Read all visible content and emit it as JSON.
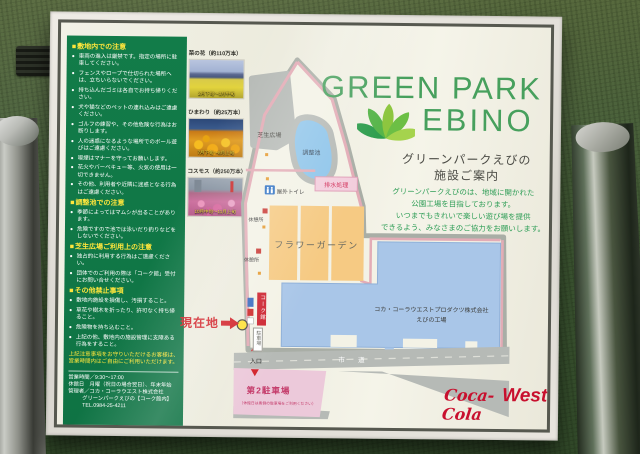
{
  "sign": {
    "title_line1": "GREEN PARK",
    "title_line2": "EBINO",
    "subtitle_line1": "グリーンパークえびの",
    "subtitle_line2": "施設ご案内",
    "description_lines": [
      "グリーンパークえびのは、地域に開かれた",
      "公園工場を目指しております。",
      "いつまでもきれいで楽しい遊び場を提供",
      "できるよう、みなさまのご協力をお願いします。"
    ],
    "brand": {
      "script": "Coca-Cola",
      "west": "West"
    },
    "colors": {
      "brand_red": "#c8102e",
      "panel_green": "#127c49",
      "title_green": "#47a05d"
    }
  },
  "notices": {
    "sections": [
      {
        "heading": "敷地内での注意",
        "items": [
          "車両の進入は厳禁です。指定の場所に駐車してください。",
          "フェンスやロープで仕切られた場所へは、立ちいらないでください。",
          "持ち込んだゴミは各自でお持ち帰りください。",
          "犬や猫などのペットの連れ込みはご遠慮ください。",
          "ゴルフの練習や、その他危険な行為はお断りします。",
          "人の迷惑になるような場所でのボール遊びはご遠慮ください。",
          "喫煙はマナーを守ってお願いします。",
          "花火やバーベキュー等、火気の使用は一切できません。",
          "その他、利用者や近隣に迷惑となる行為はご遠慮ください。"
        ]
      },
      {
        "heading": "調整池での注意",
        "items": [
          "季節によってはマムシが出ることがあります。",
          "危険ですので池では泳いだり釣りなどをしないでください。"
        ]
      },
      {
        "heading": "芝生広場ご利用上の注意",
        "items": [
          "独占的に利用する行為はご遠慮ください。",
          "団体でのご利用の際は「コーク館」受付にお問い合せください。"
        ]
      },
      {
        "heading": "その他禁止事項",
        "items": [
          "敷地内施設を損傷し、汚損すること。",
          "草花や樹木を折ったり、許可なく持ち帰ること。",
          "危険物を持ち込むこと。",
          "上記の他、敷地内の施設管理に支障ある行為をすること。"
        ]
      }
    ],
    "note": "上記注意事項をお守りいただけるお客様は、営業時間内はご自由にご利用いただけます。",
    "info_lines": {
      "hours": "営業時間／9:30～17:00",
      "closed": "休館日　月曜（祝日の場合翌日）、年末年始",
      "manager": "管理者／コカ・コーラウエスト株式会社",
      "facility": "グリーンパークえびの【コーク館内】",
      "tel": "TEL.0984-25-4211"
    }
  },
  "flowers": [
    {
      "label": "菜の花（約110万本）",
      "season": "2月下旬～3月中旬"
    },
    {
      "label": "ひまわり（約25万本）",
      "season": "7月下旬～8月上旬"
    },
    {
      "label": "コスモス（約250万本）",
      "season": "10月中旬～11月上旬"
    }
  ],
  "map": {
    "labels": {
      "lawn": "芝生広場",
      "pond": "調整池",
      "drainage": "排水処理",
      "toilet": "屋外トイレ",
      "rest1": "休憩所",
      "rest2": "休憩所",
      "flower_garden": "フラワーガーデン",
      "factory_line1": "コカ・コーラウエストプロダクツ株式会社",
      "factory_line2": "えびの工場",
      "coke_hall": "コーク館",
      "parking": "駐車場",
      "entrance": "入口",
      "road": "市道",
      "parking2": "第2駐車場",
      "parking2_note": "（休館日は奥側の駐車場をご利用ください）",
      "current_location": "現在地"
    }
  }
}
